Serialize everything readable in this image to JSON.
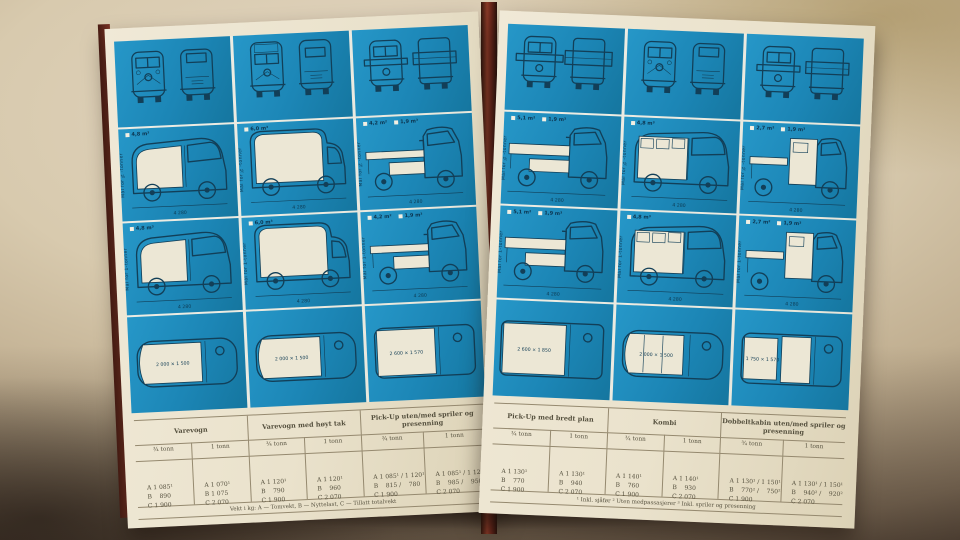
{
  "scene": {
    "description": "Photo of an open vintage VW Transporter brochure spread, blue pages with van diagrams and weight tables",
    "background_hex": "#d8caae",
    "panel_blue_hex": "#1c86b6",
    "page_hex": "#eae2cc",
    "ink_hex": "#123f58",
    "spine_red_hex": "#7c3526"
  },
  "shared": {
    "caption_34": "Mål for ¾-tonner",
    "caption_1": "Mål for 1-tonner"
  },
  "left_page": {
    "columns": [
      {
        "id": "varevogn",
        "chips": [
          "4,8 m³"
        ],
        "dims": {
          "side": "4 280",
          "plan": "2 000 × 1 500"
        }
      },
      {
        "id": "varevogn-hoyt-tak",
        "chips": [
          "6,0 m³"
        ],
        "dims": {
          "side": "4 280",
          "plan": "2 000 × 1 500"
        }
      },
      {
        "id": "pick-up",
        "chips": [
          "4,2 m²",
          "1,9 m³"
        ],
        "dims": {
          "side": "4 280",
          "plan": "2 600 × 1 570"
        }
      }
    ],
    "table": {
      "groups": [
        {
          "title": "Varevogn",
          "variants": [
            {
              "load": "¾ tonn",
              "a": "A 1 085¹",
              "b": "B    890",
              "c": "C 1 900"
            },
            {
              "load": "1 tonn",
              "a": "A 1 070¹",
              "b": "B 1 075",
              "c": "C 2 070"
            }
          ]
        },
        {
          "title": "Varevogn med høyt tak",
          "variants": [
            {
              "load": "¾ tonn",
              "a": "A 1 120¹",
              "b": "B    790",
              "c": "C 1 900"
            },
            {
              "load": "1 tonn",
              "a": "A 1 120¹",
              "b": "B    960",
              "c": "C 2 070"
            }
          ]
        },
        {
          "title": "Pick-Up uten/med spriler og presenning",
          "variants": [
            {
              "load": "¾ tonn",
              "a": "A 1 085¹ / 1 120¹",
              "b": "B    815 /    780",
              "c": "C 1 900"
            },
            {
              "load": "1 tonn",
              "a": "A 1 085¹ / 1 120¹",
              "b": "B    985 /    950",
              "c": "C 2 070"
            }
          ]
        }
      ],
      "footer": "Vekt i kg: A — Tomvekt,  B — Nyttelast,  C — Tillatt totalvekt"
    }
  },
  "right_page": {
    "columns": [
      {
        "id": "pick-up-bredt-plan",
        "chips": [
          "5,1 m²",
          "1,9 m³"
        ],
        "dims": {
          "side": "4 280",
          "plan": "2 600 × 1 850"
        }
      },
      {
        "id": "kombi",
        "chips": [
          "4,8 m³"
        ],
        "dims": {
          "side": "4 280",
          "plan": "2 000 × 1 500"
        }
      },
      {
        "id": "dobbeltkabin",
        "chips": [
          "2,7 m²",
          "1,9 m³"
        ],
        "dims": {
          "side": "4 280",
          "plan": "1 750 × 1 570"
        }
      }
    ],
    "table": {
      "groups": [
        {
          "title": "Pick-Up med bredt plan",
          "variants": [
            {
              "load": "¾ tonn",
              "a": "A 1 130¹",
              "b": "B    770",
              "c": "C 1 900"
            },
            {
              "load": "1 tonn",
              "a": "A 1 130¹",
              "b": "B    940",
              "c": "C 2 070"
            }
          ]
        },
        {
          "title": "Kombi",
          "variants": [
            {
              "load": "¾ tonn",
              "a": "A 1 140¹",
              "b": "B    760",
              "c": "C 1 900"
            },
            {
              "load": "1 tonn",
              "a": "A 1 140¹",
              "b": "B    930",
              "c": "C 2 070"
            }
          ]
        },
        {
          "title": "Dobbeltkabin uten/med spriler og presenning",
          "variants": [
            {
              "load": "¾ tonn",
              "a": "A 1 130¹ / 1 150¹",
              "b": "B    770² /    750²",
              "c": "C 1 900"
            },
            {
              "load": "1 tonn",
              "a": "A 1 130¹ / 1 150¹",
              "b": "B    940² /    920²",
              "c": "C 2 070"
            }
          ]
        }
      ],
      "footer": "¹ Inkl. sjåfør    ² Uten medpassasjerer    ³ Inkl. spriler og presenning"
    }
  }
}
